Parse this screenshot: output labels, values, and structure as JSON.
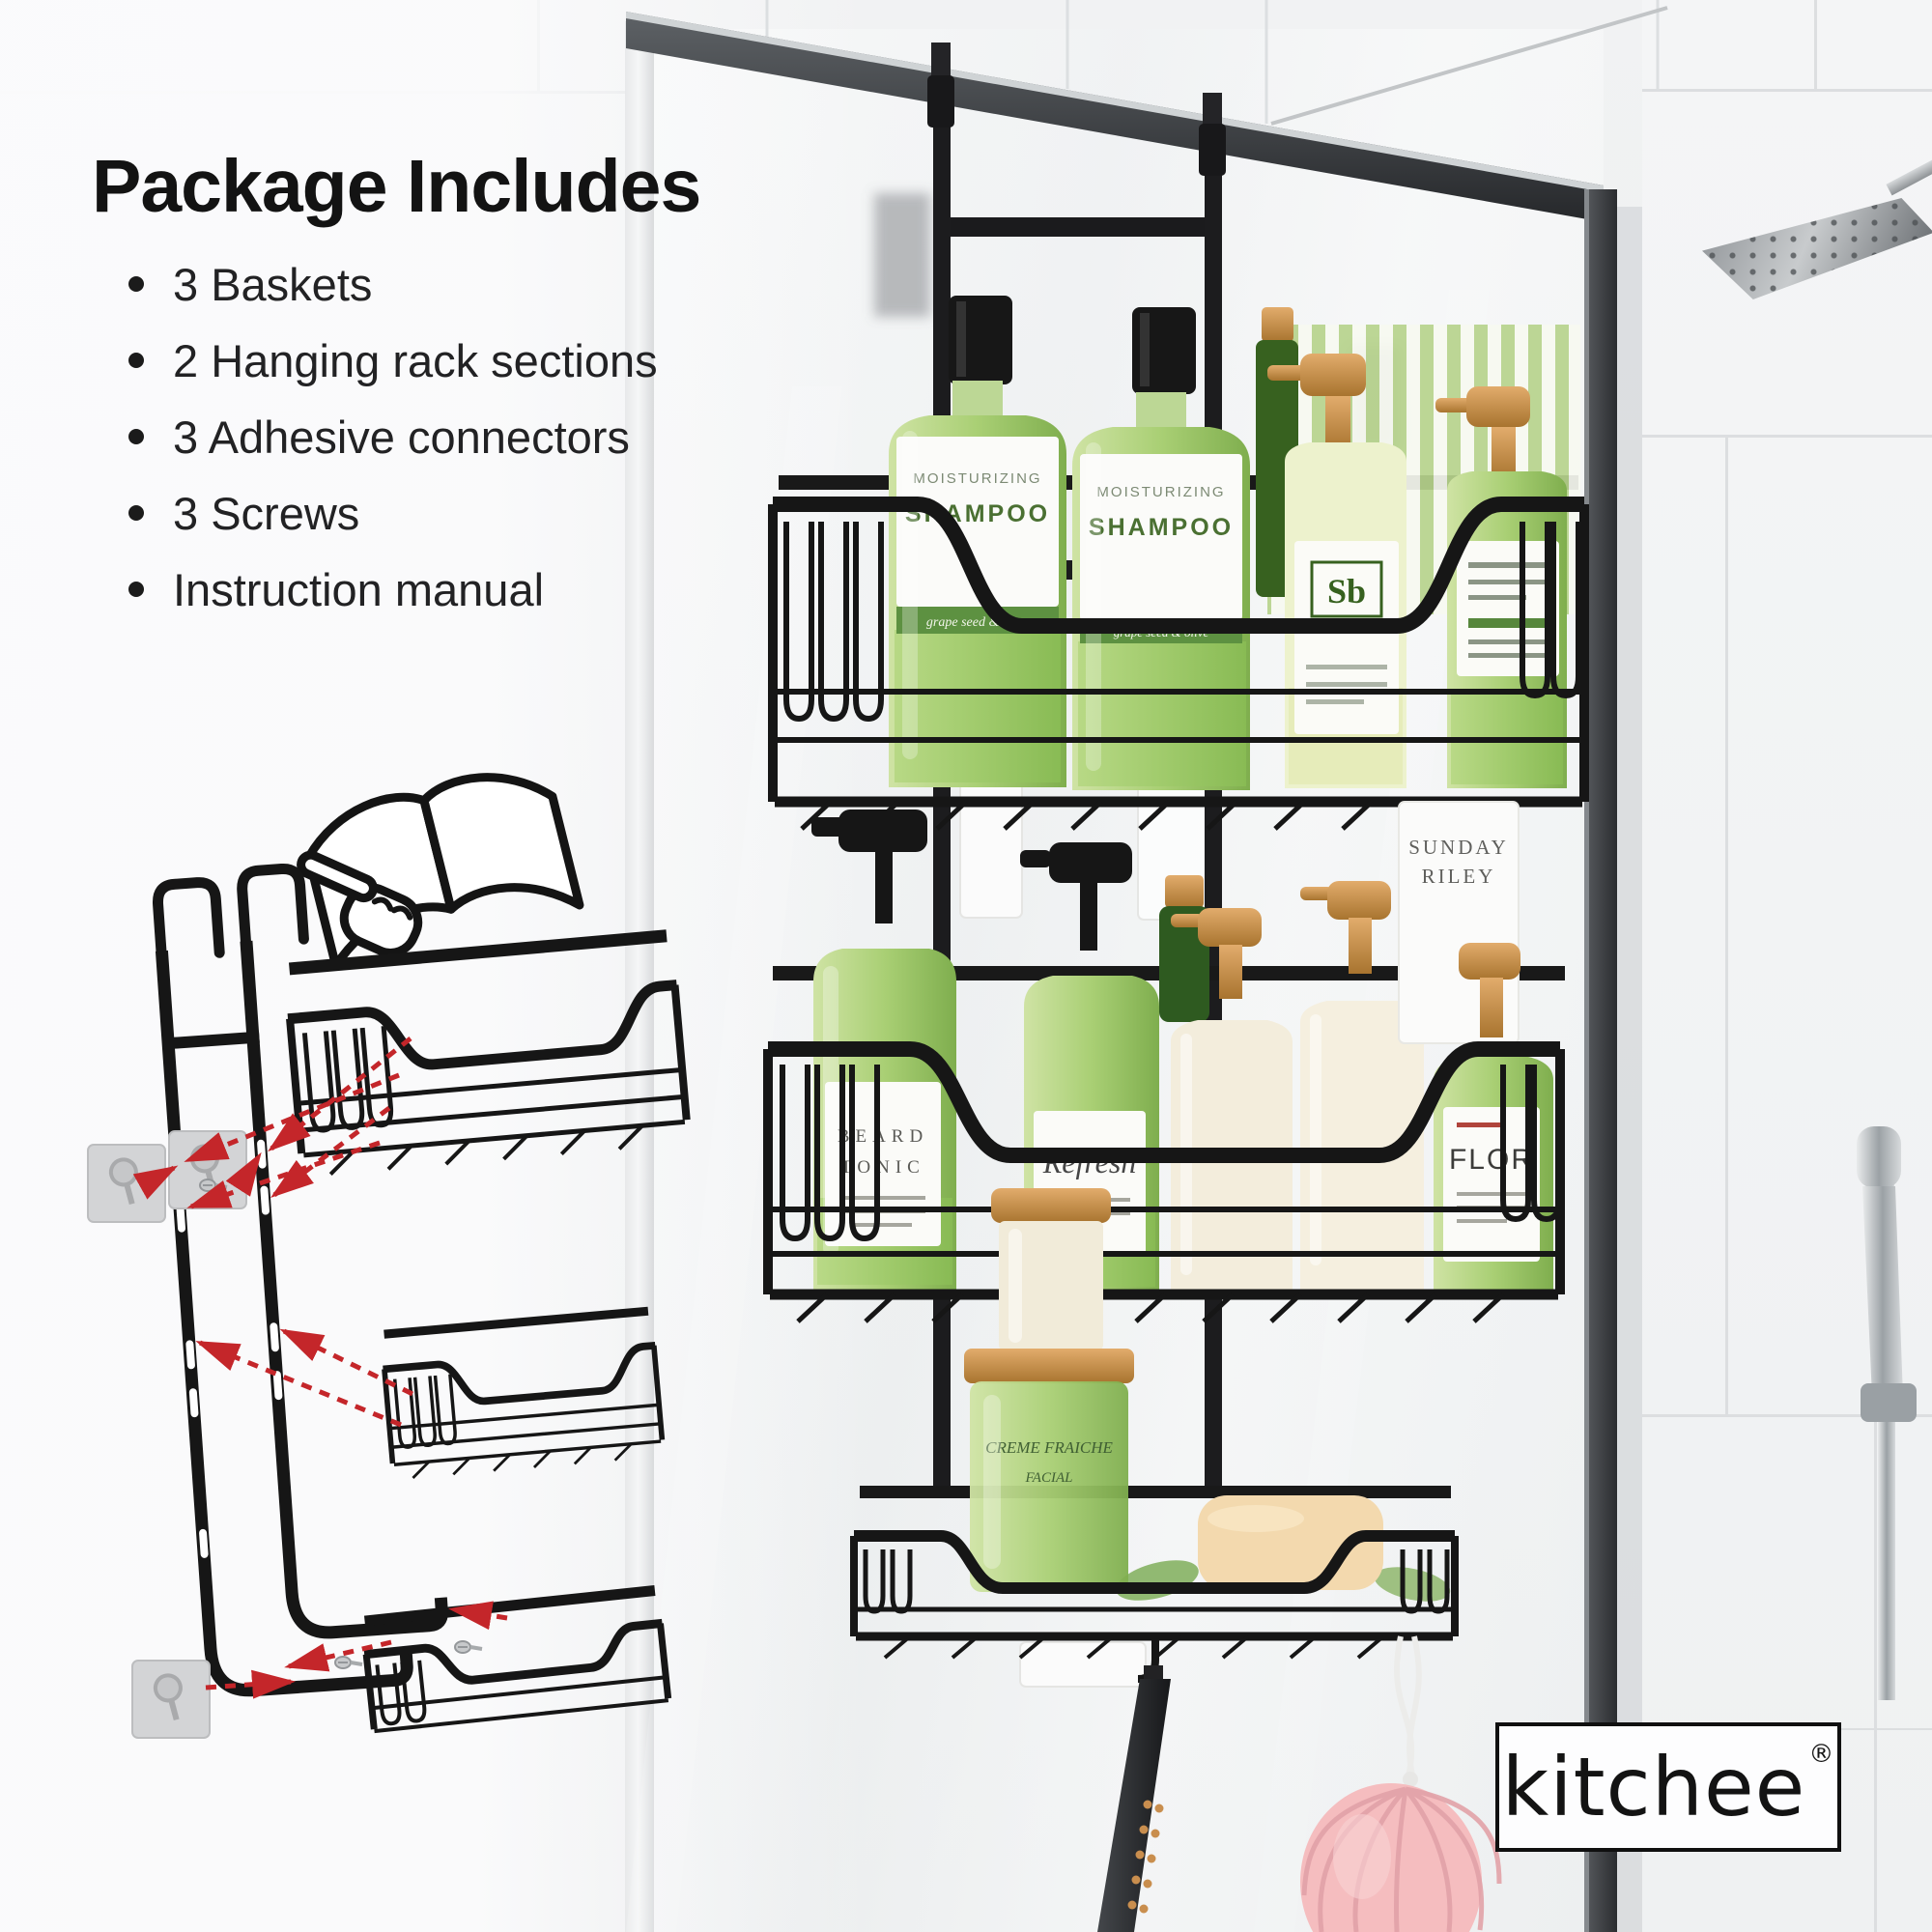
{
  "page": {
    "background": "#eef0f1"
  },
  "package_includes": {
    "heading": "Package Includes",
    "items": [
      "3 Baskets",
      "2 Hanging rack sections",
      "3 Adhesive connectors",
      "3 Screws",
      "Instruction manual"
    ]
  },
  "brand": {
    "name": "kitchee",
    "registered_mark": "®"
  },
  "photo_labels": {
    "moisturizing": "MOISTURIZING",
    "shampoo": "SHAMPOO",
    "band": "grape seed & olive",
    "sb": "Sb",
    "sunday": "SUNDAY",
    "riley": "RILEY",
    "flor": "FLOR",
    "refresh": "Refresh",
    "beard": "BEARD",
    "tonic": "TONIC",
    "jar_line1": "CREME FRAICHE",
    "jar_line2": "FACIAL"
  },
  "palette": {
    "accent_red": "#c4262a",
    "rack_black": "#171717",
    "bottle_green": "#a9cf74",
    "copper": "#c08448",
    "cream": "#f3eddc",
    "soap_beige": "#f3d9ae",
    "loofah_pink": "#f5bdbf",
    "tile_grout": "#dcdee0",
    "text_black": "#151515"
  }
}
